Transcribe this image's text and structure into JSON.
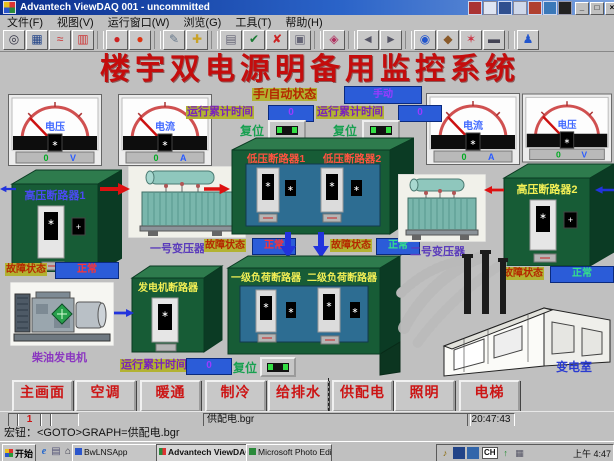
{
  "window": {
    "title": "Advantech ViewDAQ 001 - uncommitted",
    "minimize": "_",
    "maximize": "□",
    "close": "×"
  },
  "menu": {
    "items": [
      "文件(F)",
      "视图(V)",
      "运行窗口(W)",
      "浏览(G)",
      "工具(T)",
      "帮助(H)"
    ]
  },
  "toolbar": {
    "icons": [
      {
        "name": "zoom-icon",
        "glyph": "◎"
      },
      {
        "name": "panel-icon",
        "glyph": "▦"
      },
      {
        "name": "trend-chart-icon",
        "glyph": "≈"
      },
      {
        "name": "bar-chart-icon",
        "glyph": "▥"
      },
      {
        "name": "alarm-ball-icon",
        "glyph": "●"
      },
      {
        "name": "alarm-ack-icon",
        "glyph": "●"
      },
      {
        "name": "pen-icon",
        "glyph": "✎"
      },
      {
        "name": "key-icon",
        "glyph": "✚"
      },
      {
        "name": "report-icon",
        "glyph": "▤"
      },
      {
        "name": "check-green-icon",
        "glyph": "✔"
      },
      {
        "name": "check-red-icon",
        "glyph": "✘"
      },
      {
        "name": "tag-icon",
        "glyph": "▣"
      },
      {
        "name": "palette-icon",
        "glyph": "◈"
      },
      {
        "name": "back-icon",
        "glyph": "◄"
      },
      {
        "name": "forward-icon",
        "glyph": "►"
      },
      {
        "name": "globe-icon",
        "glyph": "◉"
      },
      {
        "name": "dog-icon",
        "glyph": "◆"
      },
      {
        "name": "compass-icon",
        "glyph": "✶"
      },
      {
        "name": "clapper-icon",
        "glyph": "▬"
      },
      {
        "name": "user-icon",
        "glyph": "♟"
      }
    ]
  },
  "hmi": {
    "title": "楼宇双电源明备用监控系统",
    "mode_label": "手/自动状态",
    "mode_value": "手动",
    "runtime_label": "运行累计时间",
    "runtime_value_a": "0",
    "runtime_value_b": "0",
    "runtime_value_c": "0",
    "reset_label": "复位",
    "fault_label": "故障状态",
    "status_normal": "正常",
    "meters": [
      {
        "label": "电压",
        "value": "0",
        "unit": "V"
      },
      {
        "label": "电流",
        "value": "0",
        "unit": "A"
      },
      {
        "label": "电流",
        "value": "0",
        "unit": "A"
      },
      {
        "label": "电压",
        "value": "0",
        "unit": "V"
      }
    ],
    "panels": {
      "hv1": "高压断路器1",
      "lv1": "低压断路器1",
      "lv2": "低压断路器2",
      "load1": "一级负荷断路器",
      "load2": "二级负荷断路器",
      "gen": "发电机断路器",
      "hv2": "高压断路器2"
    },
    "devices": {
      "transformer1": "一号变压器",
      "transformer2": "二号变压器",
      "generator": "柴油发电机",
      "substation": "变电室"
    }
  },
  "nav": {
    "buttons": [
      "主画面",
      "空调",
      "暖通",
      "制冷",
      "给排水",
      "供配电",
      "照明",
      "电梯"
    ]
  },
  "statusbar": {
    "page": "1",
    "graph": "供配电.bgr",
    "time": "20:47:43",
    "macro": "宏钮：<GOTO>GRAPH=供配电.bgr"
  },
  "taskbar": {
    "start": "开始",
    "tasks": [
      "BwLNSApp",
      "Advantech ViewDAQ 001...",
      "Microsoft Photo Editor ..."
    ],
    "lang": "CH",
    "clock": "上午 4:47"
  }
}
